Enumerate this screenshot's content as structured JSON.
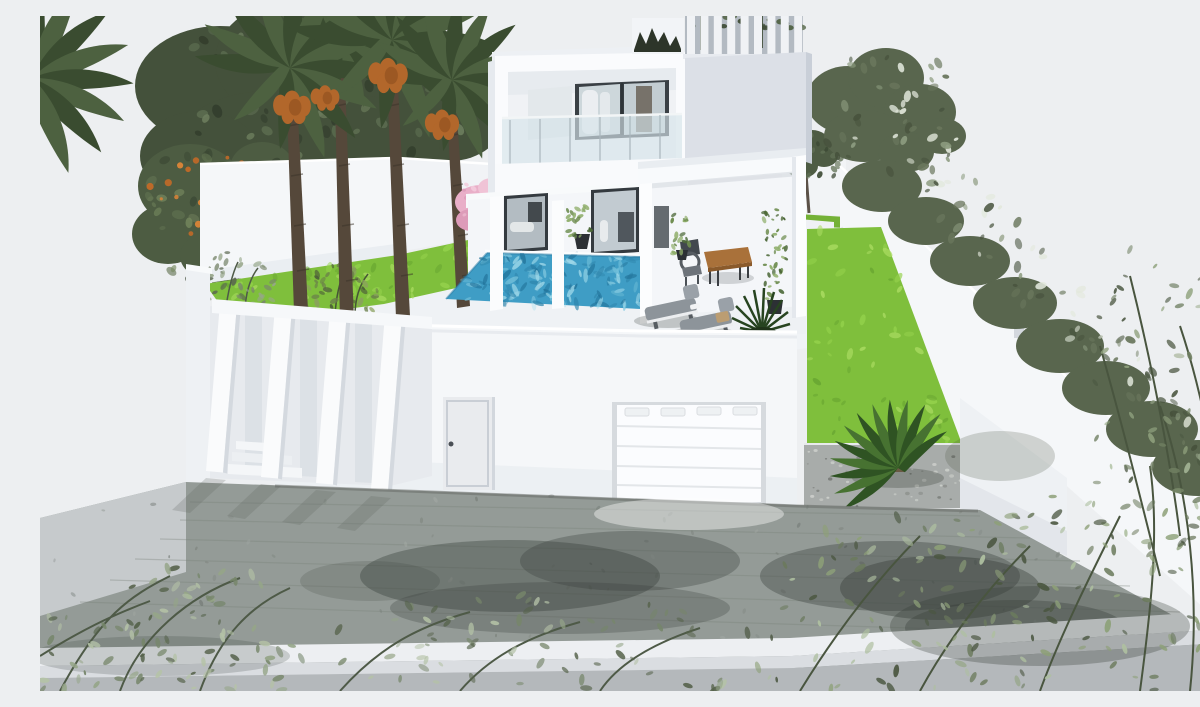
{
  "meta": {
    "title": "Modern villa exterior 3D render",
    "description": "3D architectural rendering of a modern two-storey white villa with a rooftop slat railing, glass balcony, covered patio with wooden dining table, turquoise swimming pool, sun loungers, date palms with fruit clusters, bright green lawns, white boundary walls with an olive hedge, a white garage door, angled entrance fins with steps, and a grey paved driveway framed by foreground shrubs.",
    "width_px": 1200,
    "height_px": 675
  },
  "palette": {
    "sky": "#edeff1",
    "house_white": "#fafbfd",
    "wall_white": "#f5f7f9",
    "wall_shade": "#dde1e7",
    "tower_gray": "#dce0e7",
    "deck_white": "#eff2f5",
    "glass_frame": "#3a4045",
    "glass_pane": "#cdd7db",
    "balustrade_glass": "#d5e3ea",
    "pool_water": "#3f9dc5",
    "pool_light": "#7cc5de",
    "pool_dark": "#2e84ab",
    "lawn_green": "#7fbf3c",
    "lawn_light": "#97d44e",
    "foliage_dark": "#44513b",
    "foliage_olive": "#59664e",
    "palm_green": "#3a4c30",
    "trunk_brown": "#55483a",
    "dates_orange": "#b2672b",
    "blossom_pink": "#e9afc8",
    "wood_brown": "#a9713a",
    "paving_gray": "#949b97",
    "paving_light": "#c6cacc",
    "stain_dark": "#383e3a",
    "gravel_gray": "#a8acaa",
    "curb_white": "#edeff2",
    "street_gray": "#b4b8bb",
    "furniture_gray": "#8d949a",
    "plant_pot": "#2c3034"
  },
  "scene": {
    "background": {
      "sky": "plain pale grey sky"
    },
    "villa": {
      "storeys": 2,
      "features": [
        "roof terrace with vertical slat railing and planting",
        "balcony with glass balustrade",
        "dark-framed sliding glass doors",
        "covered patio on white columns",
        "white garage door with top windows",
        "front door",
        "angled entrance fins with steps"
      ]
    },
    "pool": {
      "shape": "rectangular",
      "water": "turquoise"
    },
    "vegetation": [
      {
        "name": "date-palms",
        "count": 4,
        "detail": "orange date clusters"
      },
      {
        "name": "background-tree"
      },
      {
        "name": "orange-tree",
        "detail": "small orange fruits"
      },
      {
        "name": "blossom-tree",
        "detail": "pink flowers"
      },
      {
        "name": "boundary-hedge",
        "detail": "olive green, along right wall"
      },
      {
        "name": "sago-palm",
        "detail": "in gravel bed"
      },
      {
        "name": "climbing-plants",
        "count": 2
      },
      {
        "name": "foreground-shrubs",
        "count": 3
      }
    ],
    "furniture": [
      {
        "name": "dining-table",
        "material": "wood"
      },
      {
        "name": "dining-chairs",
        "count": 2
      },
      {
        "name": "sun-loungers",
        "count": 2,
        "cushion": "grey"
      },
      {
        "name": "potted-plants",
        "count": 3
      }
    ],
    "ground": [
      "left lawn strip",
      "right lawn strip",
      "gravel bed",
      "paved driveway with dark tyre stains",
      "white kerb wall",
      "grey street"
    ]
  }
}
